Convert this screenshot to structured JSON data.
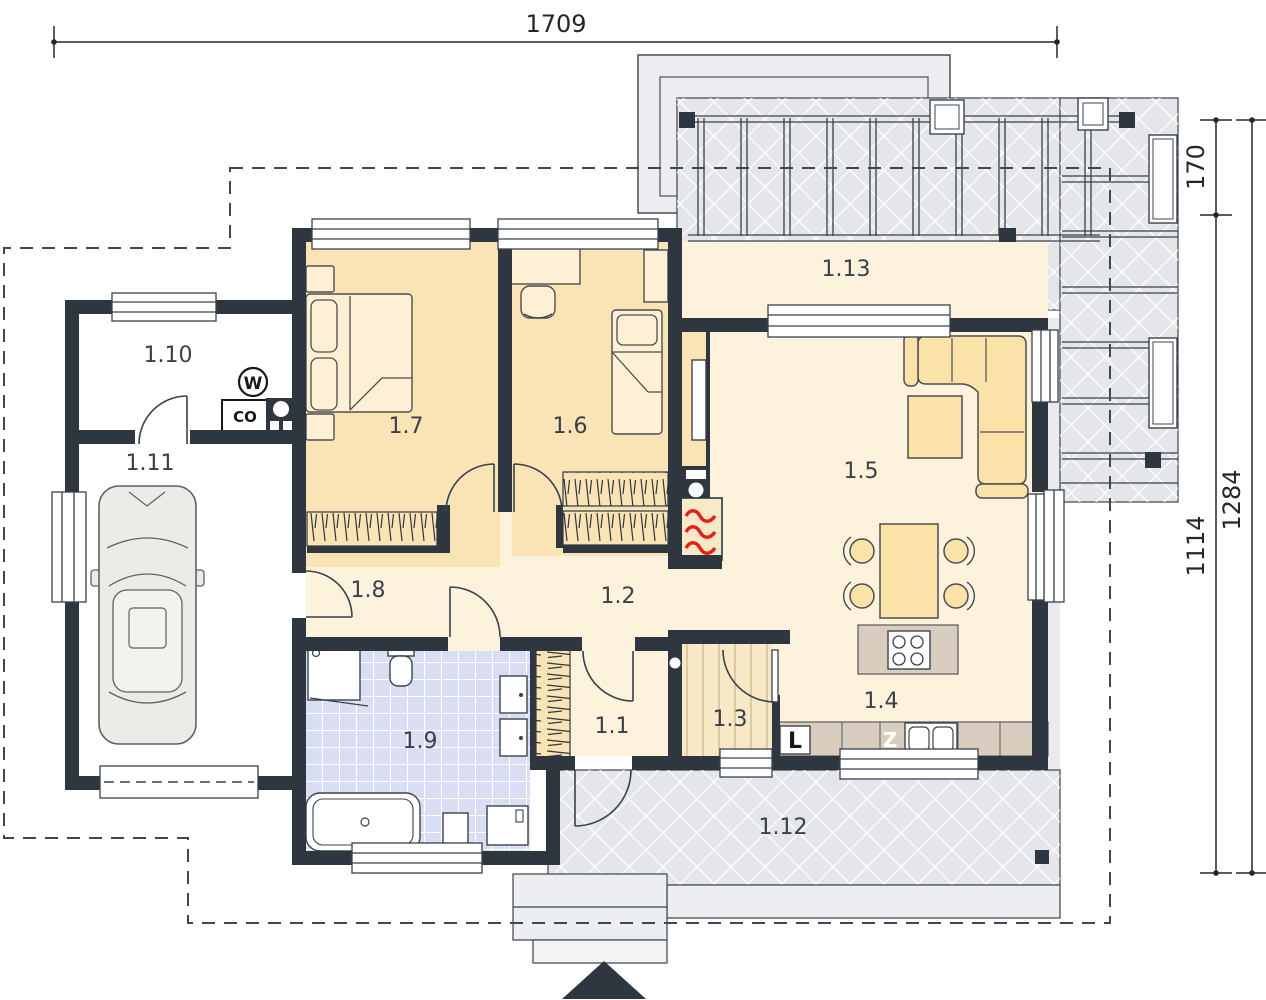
{
  "plan": {
    "type": "architectural-floor-plan",
    "floor": "ground-floor"
  },
  "dimensions": {
    "top_width": "1709",
    "right_offset": "170",
    "right_inner": "1114",
    "right_total": "1284"
  },
  "rooms": [
    {
      "label": "1.1"
    },
    {
      "label": "1.2"
    },
    {
      "label": "1.3"
    },
    {
      "label": "1.4"
    },
    {
      "label": "1.5"
    },
    {
      "label": "1.6"
    },
    {
      "label": "1.7"
    },
    {
      "label": "1.8"
    },
    {
      "label": "1.9"
    },
    {
      "label": "1.10"
    },
    {
      "label": "1.11"
    },
    {
      "label": "1.12"
    },
    {
      "label": "1.13"
    }
  ],
  "symbols": {
    "water_meter": "W",
    "heating_boiler": "CO",
    "fridge": "L",
    "sink": "Z"
  },
  "colors": {
    "wall": "#2e3740",
    "line": "#39414b",
    "cream": "#fdf2dc",
    "tan": "#fae3b4",
    "furn": "#fbe2a9",
    "counter": "#d9cdbf",
    "bath": "#d9def2",
    "gray": "#e4e6e9",
    "graylight": "#ecedf0",
    "red": "#e32119"
  }
}
